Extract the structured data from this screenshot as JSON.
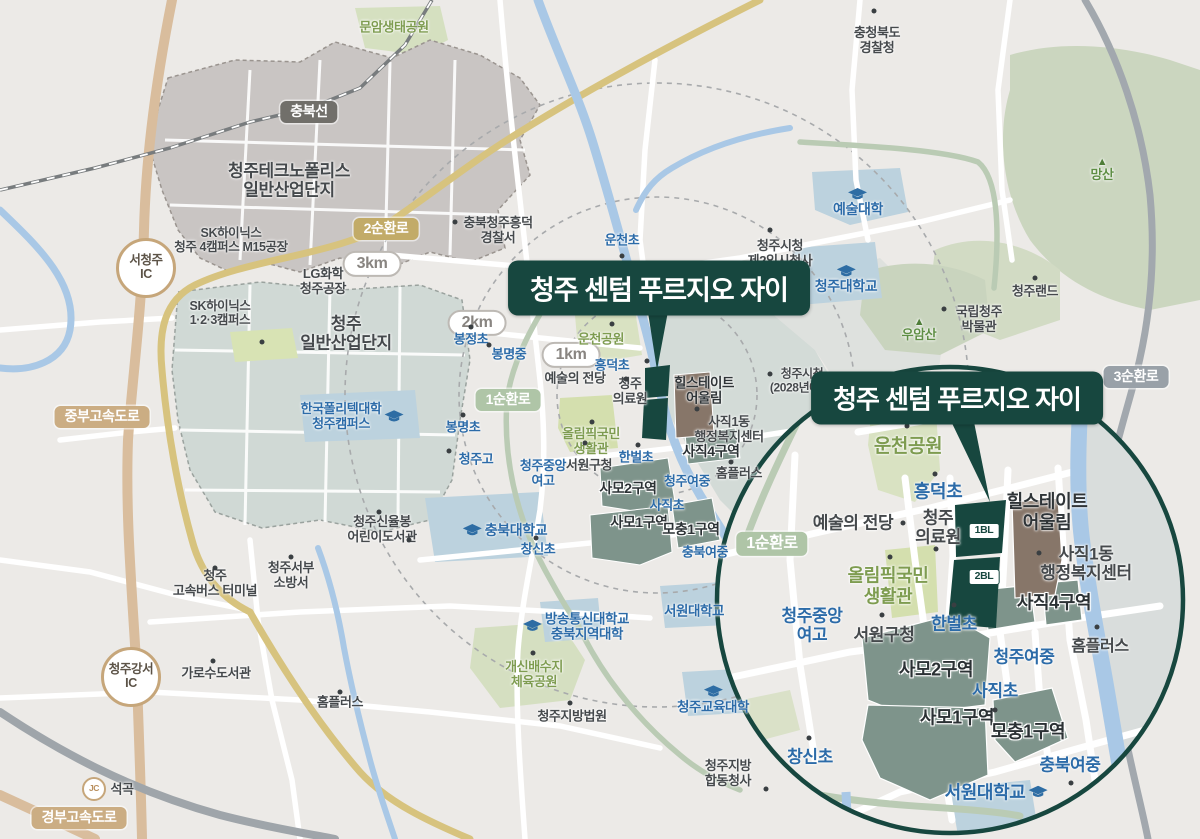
{
  "titles": {
    "main": "청주 센텀 푸르지오 자이",
    "inset": "청주 센텀 푸르지오 자이"
  },
  "colors": {
    "site_dark_teal": "#17473F",
    "zone_gray_green": "#7E948B",
    "redev_brown": "#877669",
    "river_blue": "#A9C8E6",
    "ring_road_khaki": "#D7C37E",
    "expressway_tan": "#D9BD9D",
    "outer_ring_gray": "#A2A8AE",
    "inner_ring_sage": "#BACBB4",
    "school_blue": "#2C6BA8",
    "park_green": "#7E9C50",
    "background": "#ECEAE7"
  },
  "map": {
    "labels": [
      {
        "n": "munam-eco-park",
        "t": "문암생태공원",
        "x": 394,
        "y": 28,
        "c": "prk"
      },
      {
        "n": "chungbuk-provincial-police",
        "t": "충청북도\n경찰청",
        "x": 877,
        "y": 41,
        "c": "poi"
      },
      {
        "n": "chungbuk-line-badge",
        "t": "충북선",
        "x": 309,
        "y": 112,
        "c": "bD"
      },
      {
        "n": "technopolis",
        "t": "청주테크노폴리스\n일반산업단지",
        "x": 289,
        "y": 181,
        "c": "poi",
        "s": 17
      },
      {
        "n": "sk-hynix-m15",
        "t": "SK하이닉스\n청주 4캠퍼스 M15공장",
        "x": 231,
        "y": 240,
        "c": "poi",
        "s": 12.5
      },
      {
        "n": "seocheongju-ic",
        "t": "서청주\nIC",
        "x": 146,
        "y": 268,
        "c": "ic"
      },
      {
        "n": "ring2-road-badge",
        "t": "2순환로",
        "x": 386,
        "y": 229,
        "c": "bK"
      },
      {
        "n": "km3-badge",
        "t": "3km",
        "x": 372,
        "y": 264,
        "c": "km"
      },
      {
        "n": "lg-chem-plant",
        "t": "LG화학\n청주공장",
        "x": 323,
        "y": 282,
        "c": "poi"
      },
      {
        "n": "sk-hynix-campus123",
        "t": "SK하이닉스\n1·2·3캠퍼스",
        "x": 220,
        "y": 313,
        "c": "poi",
        "s": 12.5
      },
      {
        "n": "cheongju-industrial-complex",
        "t": "청주\n일반산업단지",
        "x": 346,
        "y": 334,
        "c": "poi",
        "s": 17
      },
      {
        "n": "jungbu-expressway-badge",
        "t": "중부고속도로",
        "x": 102,
        "y": 417,
        "c": "bT"
      },
      {
        "n": "korea-polytech",
        "t": "한국폴리텍대학\n청주캠퍼스",
        "x": 352,
        "y": 417,
        "c": "sch",
        "i": "cr"
      },
      {
        "n": "mangsan-mountain",
        "t": "망산",
        "x": 1102,
        "y": 170,
        "c": "mtn",
        "i": "mt"
      },
      {
        "n": "arts-college",
        "t": "예술대학",
        "x": 858,
        "y": 203,
        "c": "sch",
        "s": 14,
        "i": "ca"
      },
      {
        "n": "cheongju-university",
        "t": "청주대학교",
        "x": 846,
        "y": 280,
        "c": "sch",
        "s": 14,
        "i": "ca"
      },
      {
        "n": "heungdeok-police",
        "t": "충북청주흥덕\n경찰서",
        "x": 498,
        "y": 231,
        "c": "poi"
      },
      {
        "n": "uncheon-elementary",
        "t": "운천초",
        "x": 622,
        "y": 241,
        "c": "sch"
      },
      {
        "n": "city-hall-temp2",
        "t": "청주시청\n제2임시청사",
        "x": 780,
        "y": 254,
        "c": "poi"
      },
      {
        "n": "cheongju-land",
        "t": "청주랜드",
        "x": 1035,
        "y": 292,
        "c": "poi"
      },
      {
        "n": "national-cheongju-museum",
        "t": "국립청주\n박물관",
        "x": 979,
        "y": 320,
        "c": "poi"
      },
      {
        "n": "uamsan-mountain",
        "t": "우암산",
        "x": 919,
        "y": 330,
        "c": "mtn",
        "i": "mt"
      },
      {
        "n": "ring3-road-badge",
        "t": "3순환로",
        "x": 1136,
        "y": 377,
        "c": "bG"
      },
      {
        "n": "city-hall-2028",
        "t": "청주시청\n(2028년예정)",
        "x": 802,
        "y": 381,
        "c": "poi",
        "s": 12
      },
      {
        "n": "km2-badge",
        "t": "2km",
        "x": 477,
        "y": 323,
        "c": "km"
      },
      {
        "n": "bongjeong-elementary",
        "t": "봉정초",
        "x": 471,
        "y": 340,
        "c": "sch"
      },
      {
        "n": "bongmyeong-middle",
        "t": "봉명중",
        "x": 509,
        "y": 355,
        "c": "sch"
      },
      {
        "n": "km1-badge",
        "t": "1km",
        "x": 571,
        "y": 355,
        "c": "km"
      },
      {
        "n": "uncheon-park",
        "t": "운천공원",
        "x": 601,
        "y": 340,
        "c": "prk"
      },
      {
        "n": "heungdeok-elementary",
        "t": "흥덕초",
        "x": 612,
        "y": 366,
        "c": "sch"
      },
      {
        "n": "arts-center",
        "t": "예술의 전당",
        "x": 575,
        "y": 379,
        "c": "poi"
      },
      {
        "n": "cheongju-medical-center",
        "t": "청주\n의료원",
        "x": 630,
        "y": 392,
        "c": "poi"
      },
      {
        "n": "hillstate-eoullim",
        "t": "힐스테이트\n어울림",
        "x": 704,
        "y": 391,
        "c": "poiS"
      },
      {
        "n": "sajik1-welfare-center",
        "t": "사직1동\n행정복지센터",
        "x": 729,
        "y": 430,
        "c": "poi"
      },
      {
        "n": "ring1-road-badge",
        "t": "1순환로",
        "x": 508,
        "y": 400,
        "c": "bS"
      },
      {
        "n": "bongmyeong-elementary",
        "t": "봉명초",
        "x": 463,
        "y": 428,
        "c": "sch"
      },
      {
        "n": "olympic-center",
        "t": "올림픽국민\n생활관",
        "x": 591,
        "y": 442,
        "c": "prk"
      },
      {
        "n": "sajik4-zone",
        "t": "사직4구역",
        "x": 711,
        "y": 452,
        "c": "zon"
      },
      {
        "n": "cheongju-high",
        "t": "청주고",
        "x": 476,
        "y": 460,
        "c": "sch"
      },
      {
        "n": "jungang-girls-high",
        "t": "청주중앙\n여고",
        "x": 543,
        "y": 474,
        "c": "sch"
      },
      {
        "n": "seowon-district-office",
        "t": "서원구청",
        "x": 589,
        "y": 466,
        "c": "poi"
      },
      {
        "n": "hanbeol-elementary",
        "t": "한벌초",
        "x": 636,
        "y": 458,
        "c": "sch"
      },
      {
        "n": "cheongju-girls-middle",
        "t": "청주여중",
        "x": 687,
        "y": 482,
        "c": "sch"
      },
      {
        "n": "homeplus",
        "t": "홈플러스",
        "x": 739,
        "y": 474,
        "c": "poi"
      },
      {
        "n": "samo2-zone",
        "t": "사모2구역",
        "x": 628,
        "y": 489,
        "c": "zon"
      },
      {
        "n": "sajik-elementary",
        "t": "사직초",
        "x": 667,
        "y": 506,
        "c": "sch"
      },
      {
        "n": "samo1-zone",
        "t": "사모1구역",
        "x": 639,
        "y": 523,
        "c": "zon"
      },
      {
        "n": "mochung1-zone",
        "t": "모충1구역",
        "x": 691,
        "y": 530,
        "c": "zon"
      },
      {
        "n": "chungbuk-university",
        "t": "충북대학교",
        "x": 505,
        "y": 531,
        "c": "sch",
        "s": 14,
        "i": "cl"
      },
      {
        "n": "sinyulbong-childrens-library",
        "t": "청주신율봉\n어린이도서관",
        "x": 382,
        "y": 530,
        "c": "poi"
      },
      {
        "n": "changsin-elementary",
        "t": "창신초",
        "x": 538,
        "y": 550,
        "c": "sch"
      },
      {
        "n": "chungbuk-girls-middle",
        "t": "충북여중",
        "x": 705,
        "y": 553,
        "c": "sch"
      },
      {
        "n": "express-bus-terminal",
        "t": "청주\n고속버스 터미널",
        "x": 215,
        "y": 584,
        "c": "poi"
      },
      {
        "n": "seobu-fire-station",
        "t": "청주서부\n소방서",
        "x": 291,
        "y": 576,
        "c": "poi"
      },
      {
        "n": "knou-chungbuk",
        "t": "방송통신대학교\n충북지역대학",
        "x": 576,
        "y": 627,
        "c": "sch",
        "s": 13.5,
        "i": "cl"
      },
      {
        "n": "seowon-university",
        "t": "서원대학교",
        "x": 694,
        "y": 611,
        "c": "sch",
        "s": 13.5
      },
      {
        "n": "gaesin-sports-park",
        "t": "개신배수지\n체육공원",
        "x": 534,
        "y": 675,
        "c": "prk"
      },
      {
        "n": "cheongju-district-court",
        "t": "청주지방법원",
        "x": 572,
        "y": 717,
        "c": "poi"
      },
      {
        "n": "education-university",
        "t": "청주교육대학",
        "x": 713,
        "y": 700,
        "c": "sch",
        "s": 13.5,
        "i": "ca"
      },
      {
        "n": "gov-joint-complex",
        "t": "청주지방\n합동청사",
        "x": 728,
        "y": 774,
        "c": "poi"
      },
      {
        "n": "garosu-library",
        "t": "가로수도서관",
        "x": 216,
        "y": 674,
        "c": "poi"
      },
      {
        "n": "homeplus-west",
        "t": "홈플러스",
        "x": 340,
        "y": 703,
        "c": "poi"
      },
      {
        "n": "gangseo-ic",
        "t": "청주강서\nIC",
        "x": 131,
        "y": 677,
        "c": "ic"
      },
      {
        "n": "seokgok-jc",
        "t": "JC",
        "x": 94,
        "y": 789,
        "c": "jc"
      },
      {
        "n": "seokgok",
        "t": "석곡",
        "x": 122,
        "y": 790,
        "c": "poi"
      },
      {
        "n": "gyeongbu-expressway-badge",
        "t": "경부고속도로",
        "x": 79,
        "y": 818,
        "c": "bT"
      },
      {
        "n": "inset-uncheon-park",
        "t": "운천공원",
        "x": 908,
        "y": 447,
        "c": "prk",
        "s": 19
      },
      {
        "n": "inset-heungdeok-elementary",
        "t": "흥덕초",
        "x": 938,
        "y": 492,
        "c": "sch",
        "s": 18
      },
      {
        "n": "inset-cheongju-medical",
        "t": "청주\n의료원",
        "x": 938,
        "y": 528,
        "c": "poi",
        "s": 17
      },
      {
        "n": "inset-arts-center",
        "t": "예술의 전당",
        "x": 853,
        "y": 523,
        "c": "poi",
        "s": 17
      },
      {
        "n": "inset-olympic-center",
        "t": "올림픽국민\n생활관",
        "x": 888,
        "y": 586,
        "c": "prk",
        "s": 18
      },
      {
        "n": "inset-ring1-road-badge",
        "t": "1순환로",
        "x": 772,
        "y": 544,
        "c": "bS",
        "s": 16
      },
      {
        "n": "inset-jungang-girls-high",
        "t": "청주중앙\n여고",
        "x": 812,
        "y": 626,
        "c": "sch",
        "s": 17
      },
      {
        "n": "inset-seowon-district-office",
        "t": "서원구청",
        "x": 884,
        "y": 635,
        "c": "poi",
        "s": 17
      },
      {
        "n": "inset-hanbeol-elementary",
        "t": "한벌초",
        "x": 954,
        "y": 624,
        "c": "sch",
        "s": 17
      },
      {
        "n": "inset-hillstate-eoullim",
        "t": "힐스테이트\n어울림",
        "x": 1047,
        "y": 512,
        "c": "poiS",
        "s": 18
      },
      {
        "n": "inset-sajik1-welfare-center",
        "t": "사직1동\n행정복지센터",
        "x": 1086,
        "y": 564,
        "c": "poi",
        "s": 17
      },
      {
        "n": "inset-sajik4-zone",
        "t": "사직4구역",
        "x": 1054,
        "y": 603,
        "c": "zon",
        "s": 18
      },
      {
        "n": "inset-homeplus",
        "t": "홈플러스",
        "x": 1100,
        "y": 647,
        "c": "poi",
        "s": 16
      },
      {
        "n": "inset-cheongju-girls-middle",
        "t": "청주여중",
        "x": 1024,
        "y": 657,
        "c": "sch",
        "s": 17
      },
      {
        "n": "inset-samo2-zone",
        "t": "사모2구역",
        "x": 936,
        "y": 670,
        "c": "zon",
        "s": 18
      },
      {
        "n": "inset-sajik-elementary",
        "t": "사직초",
        "x": 995,
        "y": 691,
        "c": "sch",
        "s": 17
      },
      {
        "n": "inset-samo1-zone",
        "t": "사모1구역",
        "x": 957,
        "y": 718,
        "c": "zon",
        "s": 18
      },
      {
        "n": "inset-mochung1-zone",
        "t": "모충1구역",
        "x": 1028,
        "y": 732,
        "c": "zon",
        "s": 18
      },
      {
        "n": "inset-chungbuk-girls-middle",
        "t": "충북여중",
        "x": 1070,
        "y": 765,
        "c": "sch",
        "s": 17
      },
      {
        "n": "inset-changsin-elementary",
        "t": "창신초",
        "x": 810,
        "y": 757,
        "c": "sch",
        "s": 17
      },
      {
        "n": "inset-seowon-university",
        "t": "서원대학교",
        "x": 996,
        "y": 793,
        "c": "sch",
        "s": 18,
        "i": "cr"
      },
      {
        "n": "block1-badge",
        "t": "1BL",
        "x": 984,
        "y": 531,
        "c": "bl"
      },
      {
        "n": "block2-badge",
        "t": "2BL",
        "x": 984,
        "y": 577,
        "c": "bl"
      }
    ],
    "dots": [
      [
        874,
        11
      ],
      [
        455,
        222
      ],
      [
        622,
        256
      ],
      [
        770,
        230
      ],
      [
        1035,
        278
      ],
      [
        944,
        309
      ],
      [
        262,
        342
      ],
      [
        471,
        327
      ],
      [
        489,
        345
      ],
      [
        612,
        324
      ],
      [
        647,
        361
      ],
      [
        626,
        379
      ],
      [
        697,
        409
      ],
      [
        585,
        443
      ],
      [
        638,
        445
      ],
      [
        463,
        415
      ],
      [
        449,
        451
      ],
      [
        592,
        422
      ],
      [
        379,
        512
      ],
      [
        536,
        538
      ],
      [
        215,
        568
      ],
      [
        291,
        557
      ],
      [
        533,
        653
      ],
      [
        570,
        703
      ],
      [
        766,
        789
      ],
      [
        213,
        661
      ],
      [
        340,
        692
      ],
      [
        731,
        462
      ],
      [
        770,
        374
      ],
      [
        409,
        540
      ],
      [
        907,
        426
      ],
      [
        935,
        474
      ],
      [
        936,
        549
      ],
      [
        890,
        557
      ],
      [
        903,
        523
      ],
      [
        882,
        615
      ],
      [
        954,
        605
      ],
      [
        1039,
        553
      ],
      [
        1097,
        627
      ],
      [
        995,
        710
      ],
      [
        1071,
        783
      ],
      [
        809,
        738
      ]
    ]
  }
}
